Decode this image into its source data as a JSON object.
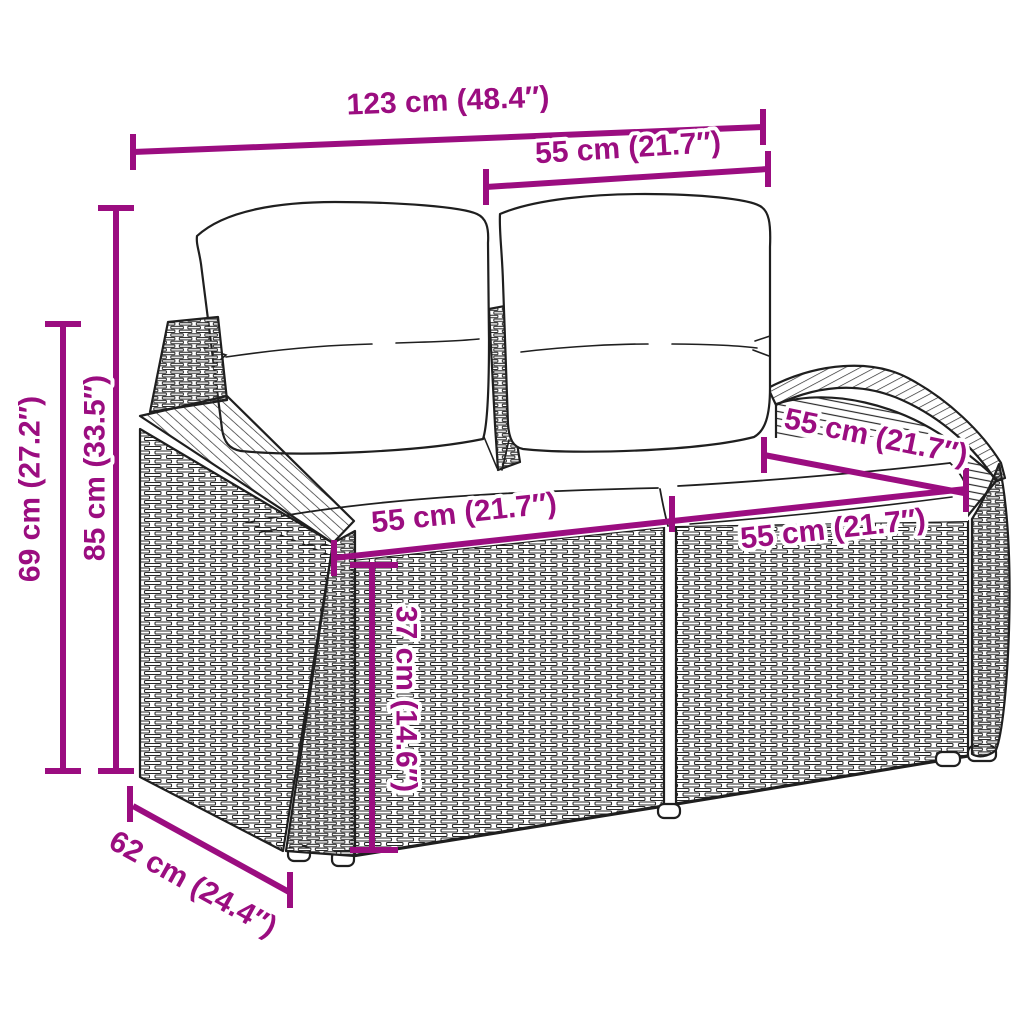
{
  "diagram": {
    "type": "product-dimension-diagram",
    "subject": "poly-rattan 2-seater garden sofa with back and seat cushions",
    "background_color": "#ffffff",
    "accent_color": "#9B0D80",
    "line_art_color": "#1f1f1f",
    "dimensions": {
      "total_width": "123 cm (48.4″)",
      "backrest_section_width": "55 cm (21.7″)",
      "seat_width_left": "55 cm (21.7″)",
      "seat_width_right": "55 cm (21.7″)",
      "seat_depth": "55 cm (21.7″)",
      "total_height": "85 cm (33.5″)",
      "armrest_height": "69 cm (27.2″)",
      "seat_height": "37 cm (14.6″)",
      "total_depth": "62 cm (24.4″)"
    }
  }
}
